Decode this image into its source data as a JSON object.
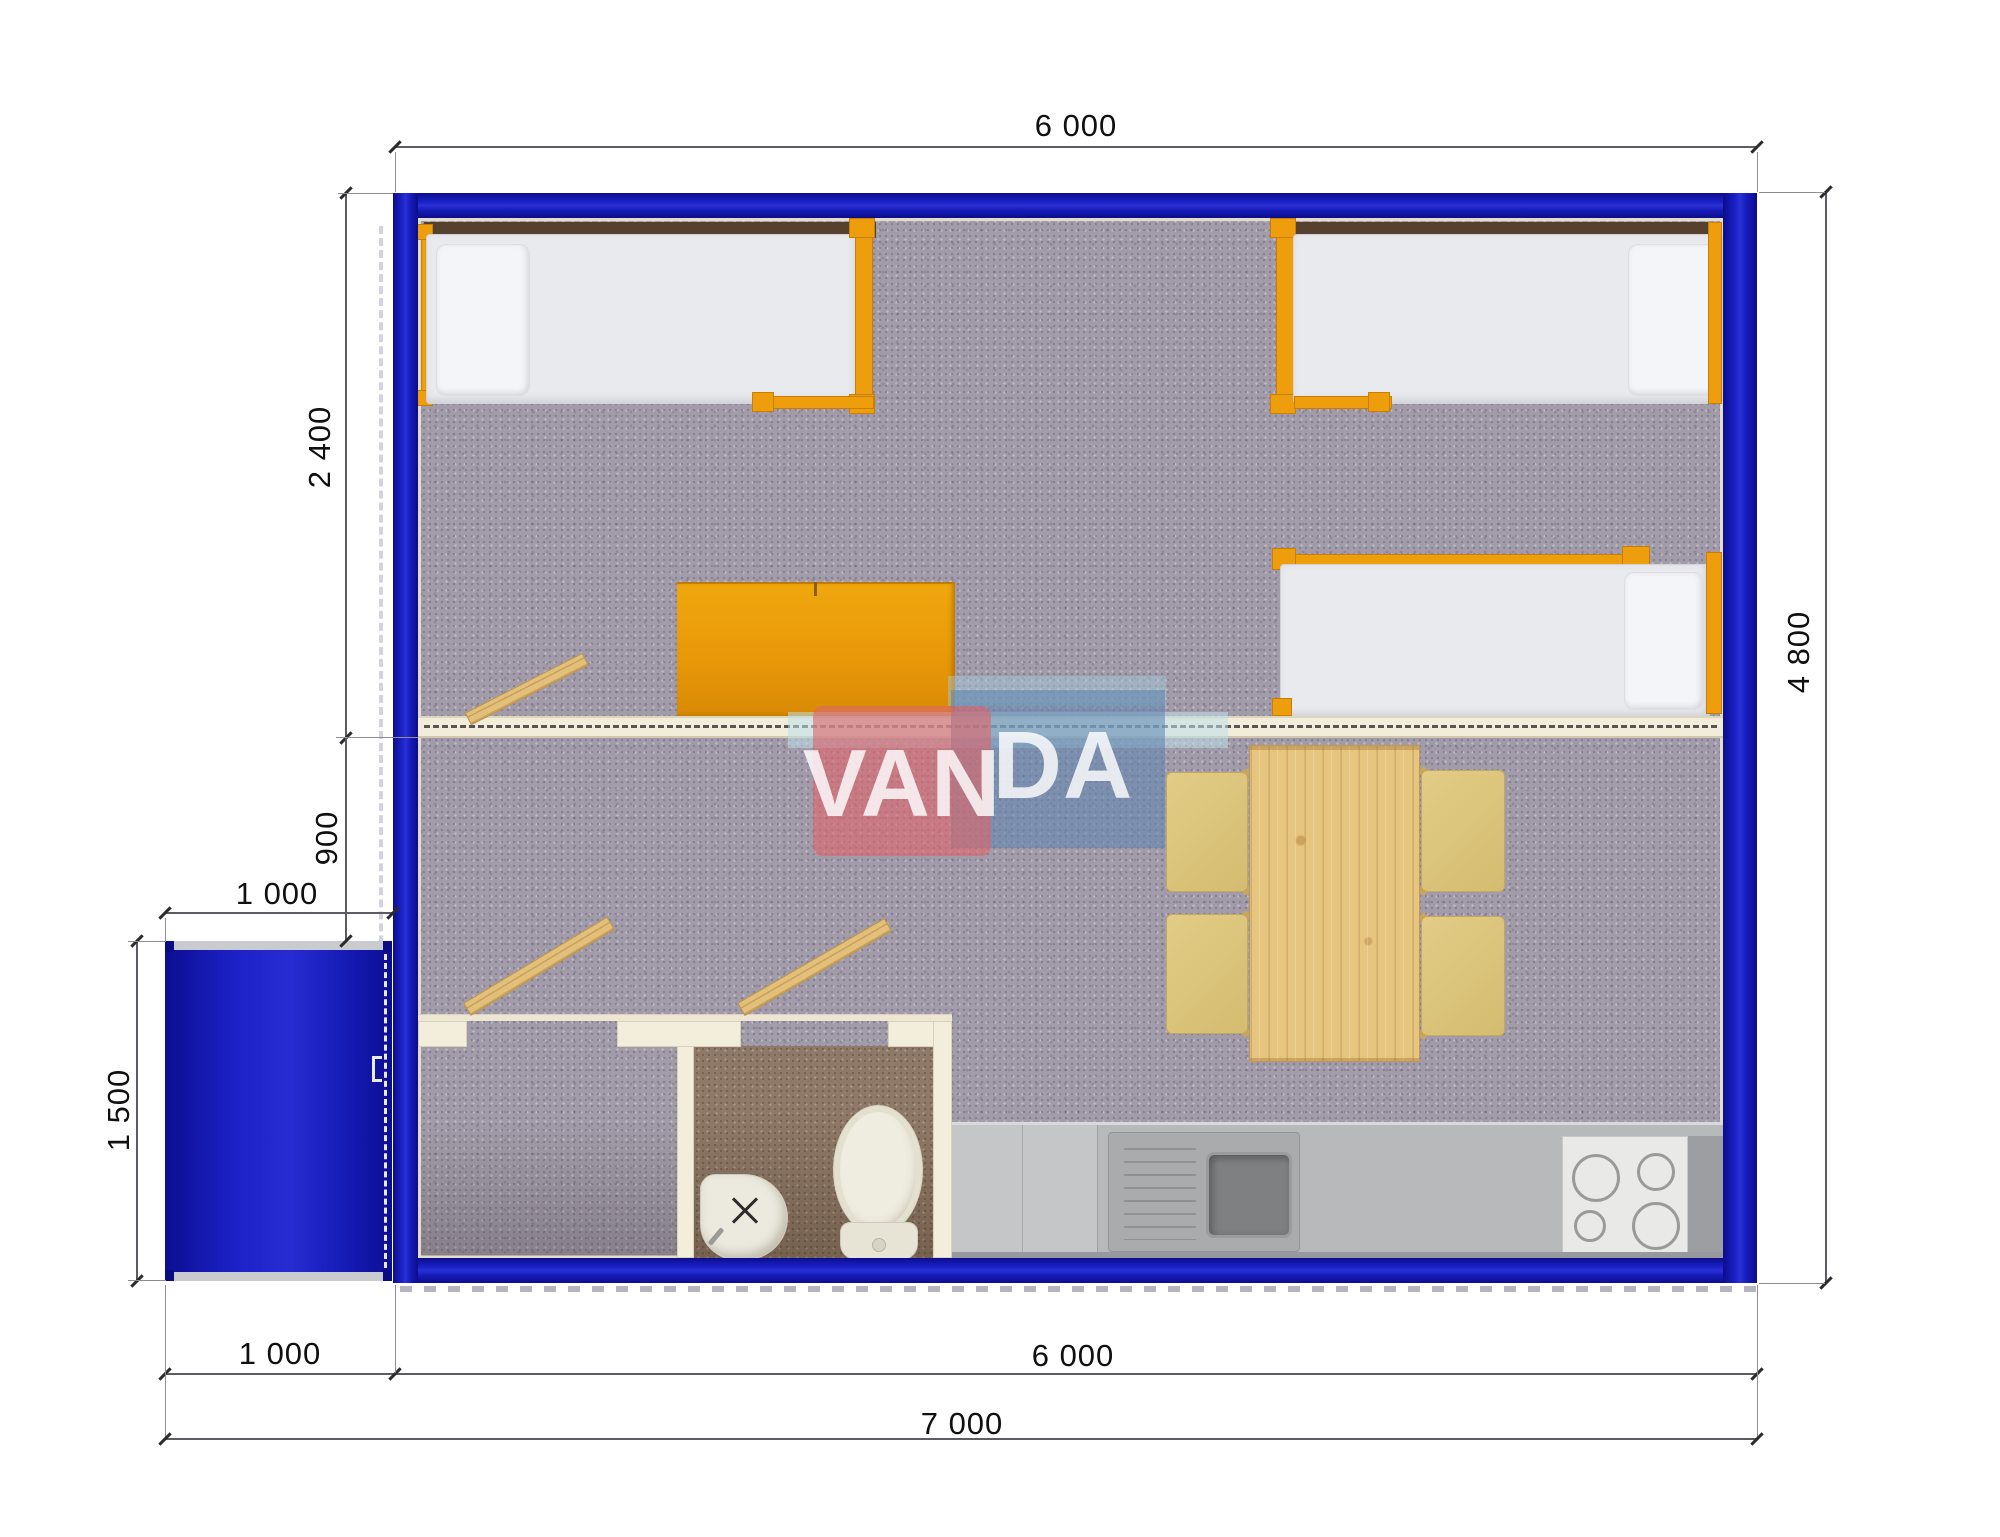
{
  "drawing": {
    "type": "floor-plan",
    "watermark": {
      "brand": "VANDA",
      "brand_left": "VAN",
      "brand_right": "DA"
    },
    "dimensions": {
      "top_width": "6 000",
      "right_height": "4 800",
      "bedroom_depth": "2 400",
      "hall_depth": "900",
      "porch_width": "1 000",
      "porch_depth": "1 500",
      "bottom_porch_width": "1 000",
      "bottom_building_width": "6 000",
      "total_width": "7 000"
    },
    "colors": {
      "wall_blue": "#151bb5",
      "partition_cream": "#f2edda",
      "furniture_orange": "#ee9e0d",
      "wood": "#e6c57f",
      "chair_khaki": "#dcc57d",
      "carpet_gray": "#a29caa",
      "carpet_brown": "#8f7a69",
      "counter_gray": "#b7b9bb",
      "watermark_red": "#dd666b",
      "watermark_blue": "#6086b2"
    }
  }
}
